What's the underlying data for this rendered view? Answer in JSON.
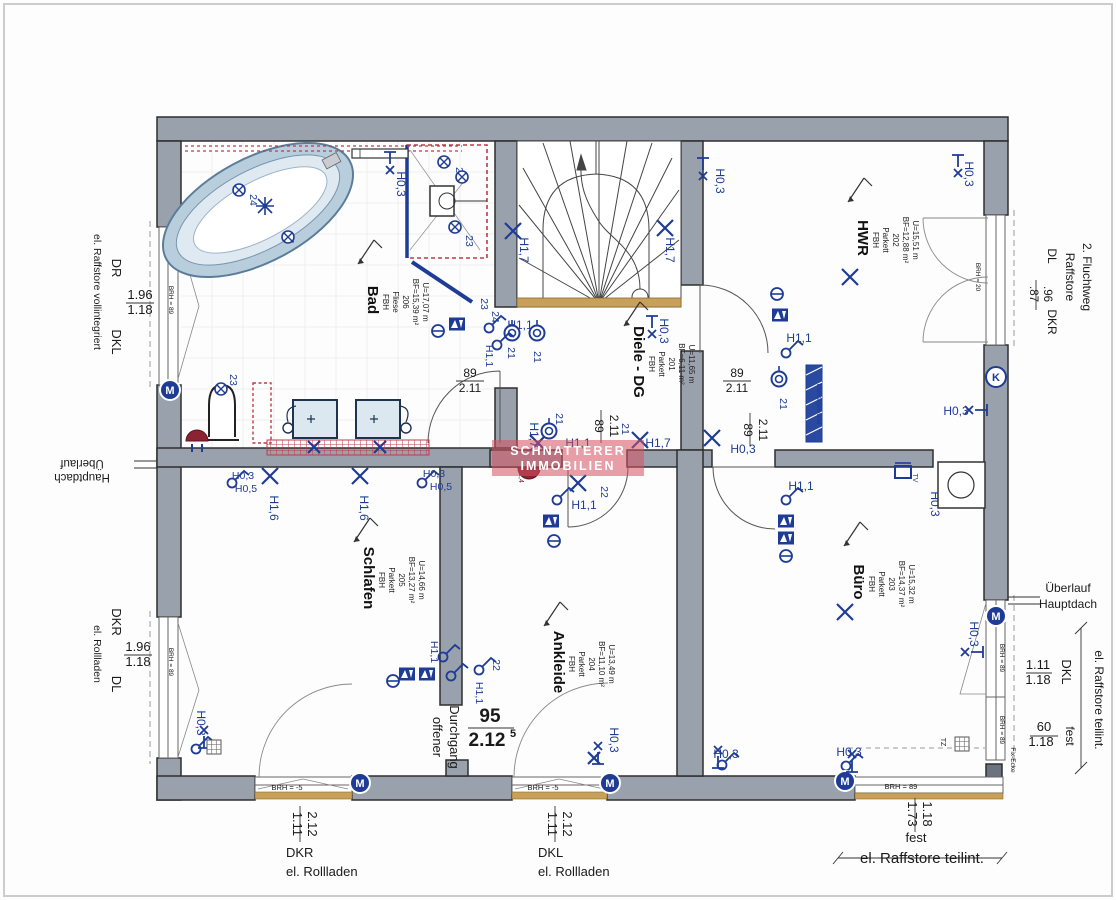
{
  "watermark": {
    "line1": "SCHNATTERER",
    "line2": "IMMOBILIEN"
  },
  "colors": {
    "wall": "#99a1ac",
    "blue": "#1e3c96",
    "red_hatch": "#c03a4a",
    "tan": "#c8a05a",
    "maroon": "#8c2332",
    "watermark": "rgba(214,80,96,0.55)"
  },
  "rooms": [
    {
      "name": "Bad",
      "x": 368,
      "y": 300,
      "lines": [
        "FBH",
        "Fliese",
        "206",
        "BF=15,39 m²",
        "U=17,07 m"
      ]
    },
    {
      "name": "Diele - DG",
      "x": 634,
      "y": 362,
      "lines": [
        "FBH",
        "Parkett",
        "201",
        "BF=6,11 m²",
        "U=11,65 m"
      ]
    },
    {
      "name": "HWR",
      "x": 858,
      "y": 238,
      "lines": [
        "FBH",
        "Parkett",
        "202",
        "BF=12,88 m²",
        "U=15,51 m"
      ]
    },
    {
      "name": "Schlafen",
      "x": 364,
      "y": 578,
      "lines": [
        "FBH",
        "Parkett",
        "205",
        "BF=13,27 m²",
        "U=14,66 m"
      ]
    },
    {
      "name": "Ankleide",
      "x": 554,
      "y": 662,
      "lines": [
        "FBH",
        "Parkett",
        "204",
        "BF=11,10 m²",
        "U=13,49 m"
      ]
    },
    {
      "name": "Büro",
      "x": 854,
      "y": 582,
      "lines": [
        "FBH",
        "Parkett",
        "203",
        "BF=14,37 m²",
        "U=15,32 m"
      ]
    }
  ],
  "labels": [
    {
      "t": "DR",
      "x": 112,
      "y": 268,
      "r": 90,
      "s": 13
    },
    {
      "t": "el. Raffstore vollintegriert",
      "x": 94,
      "y": 292,
      "r": 90,
      "s": 10.5
    },
    {
      "t": "1.96",
      "x": 140,
      "y": 299,
      "s": 13
    },
    {
      "t": "1.18",
      "x": 140,
      "y": 314,
      "s": 13
    },
    {
      "t": "DKL",
      "x": 112,
      "y": 342,
      "r": 90,
      "s": 13
    },
    {
      "t": "Überlauf",
      "x": 82,
      "y": 460,
      "r": 180,
      "s": 11.5
    },
    {
      "t": "Hauptdach",
      "x": 82,
      "y": 474,
      "r": 180,
      "s": 11.5
    },
    {
      "t": "DKR",
      "x": 112,
      "y": 622,
      "r": 90,
      "s": 13
    },
    {
      "t": "el. Rollladen",
      "x": 94,
      "y": 654,
      "r": 90,
      "s": 10.5
    },
    {
      "t": "1.96",
      "x": 138,
      "y": 651,
      "s": 13
    },
    {
      "t": "1.18",
      "x": 138,
      "y": 666,
      "s": 13
    },
    {
      "t": "DL",
      "x": 112,
      "y": 684,
      "r": 90,
      "s": 13
    },
    {
      "t": "BRH = 89",
      "x": 169,
      "y": 300,
      "r": 90,
      "s": 6.5
    },
    {
      "t": "BRH = 89",
      "x": 169,
      "y": 662,
      "r": 90,
      "s": 6.5
    },
    {
      "t": "2. Fluchtweg",
      "x": 1083,
      "y": 277,
      "r": 90,
      "s": 12
    },
    {
      "t": "Raffstore",
      "x": 1066,
      "y": 277,
      "r": 90,
      "s": 12
    },
    {
      "t": "DL",
      "x": 1048,
      "y": 256,
      "r": 90,
      "s": 12
    },
    {
      "t": ".87",
      "x": 1030,
      "y": 294,
      "r": 90,
      "s": 11.5
    },
    {
      "t": ".96",
      "x": 1044,
      "y": 294,
      "r": 90,
      "s": 11.5
    },
    {
      "t": "DKR",
      "x": 1048,
      "y": 322,
      "r": 90,
      "s": 12
    },
    {
      "t": "BRH = 20",
      "x": 976,
      "y": 277,
      "r": 90,
      "s": 6.5
    },
    {
      "t": "Überlauf",
      "x": 1068,
      "y": 592,
      "s": 12
    },
    {
      "t": "Hauptdach",
      "x": 1068,
      "y": 608,
      "s": 12
    },
    {
      "t": "el. Raffstore teilint.",
      "x": 1095,
      "y": 700,
      "r": 90,
      "s": 12
    },
    {
      "t": "DKL",
      "x": 1062,
      "y": 672,
      "r": 90,
      "s": 13
    },
    {
      "t": "1.11",
      "x": 1038,
      "y": 669,
      "s": 13
    },
    {
      "t": "1.18",
      "x": 1038,
      "y": 684,
      "s": 13
    },
    {
      "t": "fest",
      "x": 1066,
      "y": 736,
      "r": 90,
      "s": 12
    },
    {
      "t": "60",
      "x": 1044,
      "y": 731,
      "s": 13
    },
    {
      "t": "1.18",
      "x": 1041,
      "y": 746,
      "s": 13
    },
    {
      "t": "BRH = 89",
      "x": 1000,
      "y": 658,
      "r": 90,
      "s": 6.5
    },
    {
      "t": "BRH = 89",
      "x": 1000,
      "y": 730,
      "r": 90,
      "s": 6.5
    },
    {
      "t": "Fix-Ecke",
      "x": 1011,
      "y": 760,
      "r": 90,
      "s": 6.5
    },
    {
      "t": "TZ",
      "x": 941,
      "y": 742,
      "r": 90,
      "s": 7
    },
    {
      "t": "BRH = -5",
      "x": 287,
      "y": 790,
      "s": 7.5
    },
    {
      "t": "BRH = -5",
      "x": 543,
      "y": 790,
      "s": 7.5
    },
    {
      "t": "1.11",
      "x": 293,
      "y": 824,
      "r": 90,
      "s": 13
    },
    {
      "t": "2.12",
      "x": 308,
      "y": 824,
      "r": 90,
      "s": 13
    },
    {
      "t": "DKR",
      "x": 286,
      "y": 857,
      "s": 13,
      "a": "start"
    },
    {
      "t": "el. Rollladen",
      "x": 286,
      "y": 876,
      "s": 13,
      "a": "start"
    },
    {
      "t": "1.11",
      "x": 548,
      "y": 824,
      "r": 90,
      "s": 13
    },
    {
      "t": "2.12",
      "x": 563,
      "y": 824,
      "r": 90,
      "s": 13
    },
    {
      "t": "DKL",
      "x": 538,
      "y": 857,
      "s": 13,
      "a": "start"
    },
    {
      "t": "el. Rollladen",
      "x": 538,
      "y": 876,
      "s": 13,
      "a": "start"
    },
    {
      "t": "BRH = 89",
      "x": 901,
      "y": 789,
      "s": 7.5
    },
    {
      "t": "1.73",
      "x": 908,
      "y": 814,
      "r": 90,
      "s": 13
    },
    {
      "t": "1.18",
      "x": 923,
      "y": 814,
      "r": 90,
      "s": 13
    },
    {
      "t": "fest",
      "x": 916,
      "y": 842,
      "s": 13
    },
    {
      "t": "el. Raffstore teilint.",
      "x": 922,
      "y": 863,
      "s": 15
    },
    {
      "t": "89",
      "x": 470,
      "y": 377,
      "s": 12
    },
    {
      "t": "2.11",
      "x": 470,
      "y": 392,
      "s": 12
    },
    {
      "t": "89",
      "x": 737,
      "y": 377,
      "s": 12
    },
    {
      "t": "2.11",
      "x": 737,
      "y": 392,
      "s": 12
    },
    {
      "t": "89",
      "x": 595,
      "y": 426,
      "r": 90,
      "s": 12
    },
    {
      "t": "2.11",
      "x": 610,
      "y": 426,
      "r": 90,
      "s": 12
    },
    {
      "t": "89",
      "x": 744,
      "y": 430,
      "r": 90,
      "s": 12
    },
    {
      "t": "2.11",
      "x": 759,
      "y": 430,
      "r": 90,
      "s": 12
    },
    {
      "t": "95",
      "x": 490,
      "y": 722,
      "s": 19,
      "w": 1
    },
    {
      "t": "2.12",
      "x": 487,
      "y": 746,
      "s": 19,
      "w": 1
    },
    {
      "t": "5",
      "x": 513,
      "y": 737,
      "s": 11,
      "w": 1
    },
    {
      "t": "offener",
      "x": 433,
      "y": 737,
      "r": 90,
      "s": 13
    },
    {
      "t": "Durchgang",
      "x": 450,
      "y": 737,
      "r": 90,
      "s": 13
    },
    {
      "t": "H0,3",
      "x": 397,
      "y": 184,
      "r": 90,
      "s": 12,
      "c": "b"
    },
    {
      "t": "23",
      "x": 456,
      "y": 173,
      "r": 90,
      "s": 10.5,
      "c": "b"
    },
    {
      "t": "23",
      "x": 466,
      "y": 241,
      "r": 90,
      "s": 10.5,
      "c": "b"
    },
    {
      "t": "24",
      "x": 250,
      "y": 200,
      "r": 90,
      "s": 10.5,
      "c": "b"
    },
    {
      "t": "24",
      "x": 287,
      "y": 238,
      "r": 90,
      "s": 10.5,
      "c": "b"
    },
    {
      "t": "23",
      "x": 230,
      "y": 380,
      "r": 90,
      "s": 10.5,
      "c": "b"
    },
    {
      "t": "23",
      "x": 481,
      "y": 304,
      "r": 90,
      "s": 10.5,
      "c": "b"
    },
    {
      "t": "24",
      "x": 492,
      "y": 317,
      "r": 90,
      "s": 10.5,
      "c": "b"
    },
    {
      "t": "H1,1",
      "x": 486,
      "y": 356,
      "r": 90,
      "s": 10.5,
      "c": "b"
    },
    {
      "t": "H1,7",
      "x": 520,
      "y": 250,
      "r": 90,
      "s": 12,
      "c": "b"
    },
    {
      "t": "H1,7",
      "x": 666,
      "y": 250,
      "r": 90,
      "s": 12,
      "c": "b"
    },
    {
      "t": "H0,3",
      "x": 660,
      "y": 331,
      "r": 90,
      "s": 12,
      "c": "b"
    },
    {
      "t": "H0,3",
      "x": 716,
      "y": 181,
      "r": 90,
      "s": 12,
      "c": "b"
    },
    {
      "t": "H0,3",
      "x": 965,
      "y": 174,
      "r": 90,
      "s": 12,
      "c": "b"
    },
    {
      "t": "H1,1",
      "x": 520,
      "y": 329,
      "s": 12,
      "c": "b"
    },
    {
      "t": "21",
      "x": 508,
      "y": 353,
      "r": 90,
      "s": 10.5,
      "c": "b"
    },
    {
      "t": "21",
      "x": 534,
      "y": 357,
      "r": 90,
      "s": 10.5,
      "c": "b"
    },
    {
      "t": "H1,1",
      "x": 799,
      "y": 342,
      "s": 12,
      "c": "b"
    },
    {
      "t": "21",
      "x": 780,
      "y": 404,
      "r": 90,
      "s": 10.5,
      "c": "b"
    },
    {
      "t": "H0,3",
      "x": 743,
      "y": 453,
      "s": 12,
      "c": "b"
    },
    {
      "t": "H1,7",
      "x": 530,
      "y": 435,
      "r": 90,
      "s": 12,
      "c": "b"
    },
    {
      "t": "21",
      "x": 556,
      "y": 419,
      "r": 90,
      "s": 10.5,
      "c": "b"
    },
    {
      "t": "H1,1",
      "x": 578,
      "y": 447,
      "s": 12,
      "c": "b"
    },
    {
      "t": "21",
      "x": 622,
      "y": 429,
      "r": 90,
      "s": 10.5,
      "c": "b"
    },
    {
      "t": "H1,7",
      "x": 658,
      "y": 447,
      "s": 12,
      "c": "b"
    },
    {
      "t": "22",
      "x": 601,
      "y": 492,
      "r": 90,
      "s": 10.5,
      "c": "b"
    },
    {
      "t": "H1,1",
      "x": 584,
      "y": 509,
      "s": 12,
      "c": "b"
    },
    {
      "t": "H0,3",
      "x": 243,
      "y": 479,
      "s": 10.5,
      "c": "b"
    },
    {
      "t": "H0,5",
      "x": 246,
      "y": 492,
      "s": 10.5,
      "c": "b"
    },
    {
      "t": "H1,6",
      "x": 270,
      "y": 508,
      "r": 90,
      "s": 12,
      "c": "b"
    },
    {
      "t": "H1,6",
      "x": 360,
      "y": 508,
      "r": 90,
      "s": 12,
      "c": "b"
    },
    {
      "t": "H0,3",
      "x": 434,
      "y": 477,
      "s": 10.5,
      "c": "b"
    },
    {
      "t": "H0,5",
      "x": 441,
      "y": 490,
      "s": 10.5,
      "c": "b"
    },
    {
      "t": "H1,1",
      "x": 801,
      "y": 490,
      "s": 12,
      "c": "b"
    },
    {
      "t": "H0,3",
      "x": 931,
      "y": 504,
      "r": 90,
      "s": 12,
      "c": "b"
    },
    {
      "t": "H0,3",
      "x": 956,
      "y": 415,
      "s": 12,
      "c": "b"
    },
    {
      "t": "H0,3",
      "x": 970,
      "y": 634,
      "r": 90,
      "s": 12,
      "c": "b"
    },
    {
      "t": "H0,3",
      "x": 849,
      "y": 756,
      "s": 12,
      "c": "b"
    },
    {
      "t": "H0,3",
      "x": 726,
      "y": 758,
      "s": 12,
      "c": "b"
    },
    {
      "t": "H0,3",
      "x": 610,
      "y": 740,
      "r": 90,
      "s": 12,
      "c": "b"
    },
    {
      "t": "H0,3",
      "x": 197,
      "y": 723,
      "r": 90,
      "s": 12,
      "c": "b"
    },
    {
      "t": "22",
      "x": 493,
      "y": 665,
      "r": 90,
      "s": 10.5,
      "c": "b"
    },
    {
      "t": "H1,1",
      "x": 476,
      "y": 693,
      "r": 90,
      "s": 10.5,
      "c": "b"
    },
    {
      "t": "H1,1",
      "x": 431,
      "y": 652,
      "r": 90,
      "s": 10.5,
      "c": "b"
    },
    {
      "t": "Montagewand",
      "x": 817,
      "y": 404,
      "r": 90,
      "s": 6.5,
      "c": "b"
    },
    {
      "t": "TV",
      "x": 913,
      "y": 478,
      "r": 90,
      "s": 7,
      "c": "b"
    },
    {
      "t": "2,4",
      "x": 519,
      "y": 478,
      "r": 90,
      "s": 7,
      "c": "m"
    }
  ],
  "symbols": [
    {
      "t": "x",
      "x": 513,
      "y": 231
    },
    {
      "t": "x",
      "x": 665,
      "y": 228
    },
    {
      "t": "x",
      "x": 850,
      "y": 277
    },
    {
      "t": "x",
      "x": 845,
      "y": 612
    },
    {
      "t": "x",
      "x": 270,
      "y": 476
    },
    {
      "t": "x",
      "x": 360,
      "y": 476
    },
    {
      "t": "x",
      "x": 538,
      "y": 443
    },
    {
      "t": "x",
      "x": 640,
      "y": 440
    },
    {
      "t": "x",
      "x": 578,
      "y": 483
    },
    {
      "t": "x",
      "x": 712,
      "y": 438
    },
    {
      "t": "x",
      "x": 314,
      "y": 447,
      "s": 6
    },
    {
      "t": "x",
      "x": 380,
      "y": 447,
      "s": 6
    },
    {
      "t": "x",
      "x": 594,
      "y": 758,
      "s": 6
    },
    {
      "t": "star",
      "x": 265,
      "y": 206
    },
    {
      "t": "soc",
      "x": 512,
      "y": 333
    },
    {
      "t": "soc",
      "x": 537,
      "y": 333
    },
    {
      "t": "soc",
      "x": 549,
      "y": 431
    },
    {
      "t": "soc",
      "x": 779,
      "y": 379
    },
    {
      "t": "plus",
      "x": 239,
      "y": 190
    },
    {
      "t": "plus",
      "x": 288,
      "y": 237
    },
    {
      "t": "plus",
      "x": 444,
      "y": 162
    },
    {
      "t": "plus",
      "x": 462,
      "y": 177
    },
    {
      "t": "plus",
      "x": 455,
      "y": 227
    },
    {
      "t": "plus",
      "x": 221,
      "y": 389
    },
    {
      "t": "sw",
      "x": 232,
      "y": 483
    },
    {
      "t": "sw",
      "x": 422,
      "y": 483
    },
    {
      "t": "sw",
      "x": 489,
      "y": 328
    },
    {
      "t": "sw",
      "x": 497,
      "y": 345
    },
    {
      "t": "sw",
      "x": 786,
      "y": 353
    },
    {
      "t": "sw",
      "x": 786,
      "y": 500
    },
    {
      "t": "sw",
      "x": 557,
      "y": 500
    },
    {
      "t": "sw",
      "x": 479,
      "y": 670
    },
    {
      "t": "sw",
      "x": 443,
      "y": 657
    },
    {
      "t": "sw",
      "x": 451,
      "y": 676
    },
    {
      "t": "sw",
      "x": 196,
      "y": 749
    },
    {
      "t": "sw",
      "x": 846,
      "y": 766
    },
    {
      "t": "sw",
      "x": 722,
      "y": 765
    },
    {
      "t": "av",
      "x": 457,
      "y": 324
    },
    {
      "t": "av",
      "x": 780,
      "y": 315
    },
    {
      "t": "av",
      "x": 786,
      "y": 521
    },
    {
      "t": "av",
      "x": 786,
      "y": 538
    },
    {
      "t": "av",
      "x": 407,
      "y": 674
    },
    {
      "t": "av",
      "x": 427,
      "y": 674
    },
    {
      "t": "av",
      "x": 551,
      "y": 521
    },
    {
      "t": "th",
      "x": 438,
      "y": 331
    },
    {
      "t": "th",
      "x": 777,
      "y": 294
    },
    {
      "t": "th",
      "x": 786,
      "y": 556
    },
    {
      "t": "th",
      "x": 393,
      "y": 681
    },
    {
      "t": "th",
      "x": 554,
      "y": 541
    },
    {
      "t": "M",
      "x": 170,
      "y": 390
    },
    {
      "t": "M",
      "x": 360,
      "y": 783
    },
    {
      "t": "M",
      "x": 610,
      "y": 783
    },
    {
      "t": "M",
      "x": 845,
      "y": 781
    },
    {
      "t": "M",
      "x": 996,
      "y": 616
    },
    {
      "t": "K",
      "x": 996,
      "y": 377
    },
    {
      "t": "wm",
      "x": 390,
      "y": 152,
      "r": 0
    },
    {
      "t": "wm",
      "x": 703,
      "y": 158,
      "r": 0
    },
    {
      "t": "wm",
      "x": 958,
      "y": 155,
      "r": 0
    },
    {
      "t": "wm",
      "x": 987,
      "y": 410,
      "r": 90
    },
    {
      "t": "wm",
      "x": 983,
      "y": 652,
      "r": 90
    },
    {
      "t": "wm",
      "x": 652,
      "y": 316,
      "r": 0
    },
    {
      "t": "wm",
      "x": 598,
      "y": 764,
      "r": 180
    },
    {
      "t": "wm",
      "x": 718,
      "y": 768,
      "r": 180
    },
    {
      "t": "wm",
      "x": 852,
      "y": 772,
      "r": 180
    },
    {
      "t": "wm",
      "x": 204,
      "y": 748,
      "r": 180
    },
    {
      "t": "grid",
      "x": 962,
      "y": 744
    },
    {
      "t": "grid",
      "x": 214,
      "y": 747
    },
    {
      "t": "tv",
      "x": 903,
      "y": 472
    },
    {
      "t": "wash",
      "x": 938,
      "y": 462
    }
  ]
}
